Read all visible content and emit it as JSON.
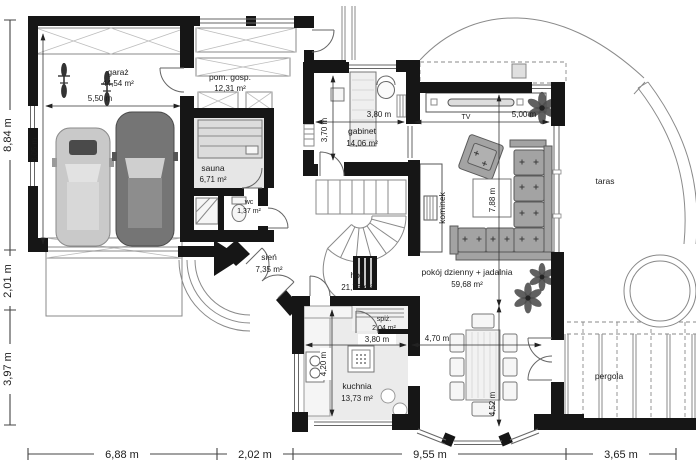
{
  "rooms": {
    "garaz": {
      "name": "garaż",
      "area": "44,54 m²"
    },
    "pom_gosp": {
      "name": "pom. gosp.",
      "area": "12,31 m²"
    },
    "sauna": {
      "name": "sauna",
      "area": "6,71 m²"
    },
    "wc": {
      "name": "wc",
      "area": "1,37 m²"
    },
    "sien": {
      "name": "sień",
      "area": "7,35 m²"
    },
    "holl": {
      "name": "holl",
      "area": "21,73 m²"
    },
    "gabinet": {
      "name": "gabinet",
      "area": "14,06 m²"
    },
    "pokoj": {
      "name": "pokój dzienny + jadalnia",
      "area": "59,68 m²"
    },
    "kuchnia": {
      "name": "kuchnia",
      "area": "13,73 m²"
    },
    "spiz": {
      "name": "spiż.",
      "area": "2,04 m²"
    }
  },
  "features": {
    "kominek": "kominek",
    "taras": "taras",
    "pergola": "pergola",
    "tv": "TV"
  },
  "dimensions": {
    "bottom": [
      "6,88 m",
      "2,02 m",
      "9,55 m",
      "3,65 m"
    ],
    "left": [
      "8,84 m",
      "2,01 m",
      "3,97 m"
    ],
    "garage_width": "5,50 m",
    "garage_depth": "8,05 m",
    "gabinet_width": "3,80 m",
    "gabinet_depth": "3,70 m",
    "living_width": "5,00 m",
    "living_depth": "7,88 m",
    "kitchen_width": "3,80 m",
    "kitchen_depth": "4,20 m",
    "dining_width": "4,70 m",
    "dining_depth": "4,52 m"
  },
  "colors": {
    "wall": "#161616",
    "line": "#8a8a8a",
    "fill_light": "#e6e6e6",
    "car_light": "#c9c9c9",
    "car_dark": "#757575",
    "sofa": "#a3a3a3",
    "plant": "#4f4f4f"
  }
}
